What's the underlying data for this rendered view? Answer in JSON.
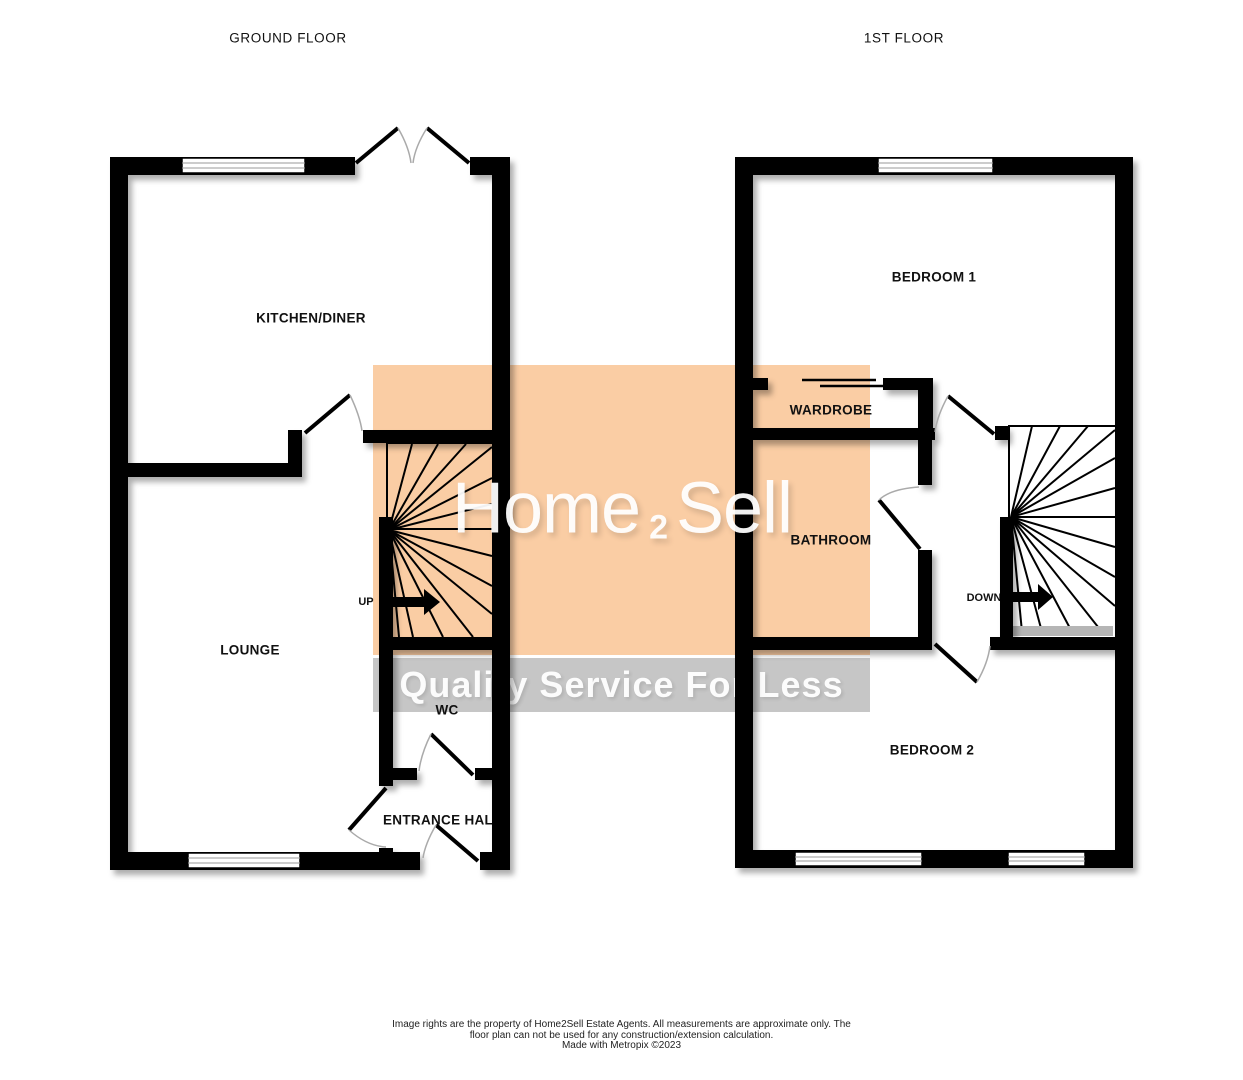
{
  "floors": {
    "ground": {
      "title": "GROUND FLOOR",
      "kitchen_diner": "KITCHEN/DINER",
      "lounge": "LOUNGE",
      "wc": "WC",
      "entrance_hall": "ENTRANCE HALL",
      "stairs_direction": "UP"
    },
    "first": {
      "title": "1ST FLOOR",
      "bedroom1": "BEDROOM 1",
      "wardrobe": "WARDROBE",
      "bathroom": "BATHROOM",
      "bedroom2": "BEDROOM 2",
      "stairs_direction": "DOWN"
    }
  },
  "watermark": {
    "brand_word1": "Home",
    "brand_digit": "2",
    "brand_word2": "Sell",
    "tagline": "Quality Service For Less",
    "colors": {
      "orange": "#FACDA4",
      "gray": "#C6C6C6",
      "text": "#FFFFFF"
    }
  },
  "footer": {
    "line1": "Image rights are the property of Home2Sell Estate Agents. All measurements are approximate only. The",
    "line2": "floor plan can not be used for any construction/extension calculation.",
    "line3": "Made with Metropix ©2023"
  }
}
